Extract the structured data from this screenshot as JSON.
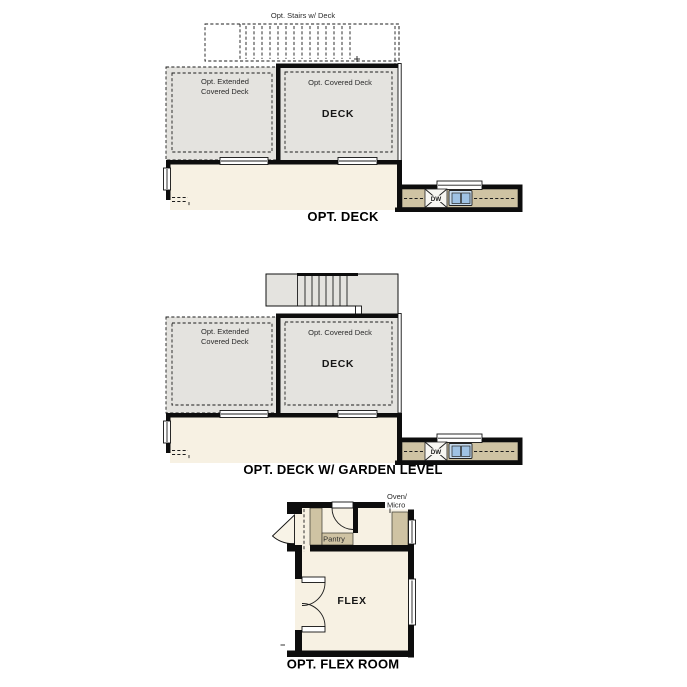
{
  "sheet": {
    "description": "Three optional floor plan diagrams stacked vertically"
  },
  "colors": {
    "deck_fill": "#e4e3df",
    "interior_fill": "#f7f1e3",
    "counter_fill": "#cfc3a3",
    "wall": "#0d0d0d",
    "sink_outer": "#c7dbee",
    "sink_basin": "#9fc2e4",
    "background": "#ffffff"
  },
  "plans": [
    {
      "title": "OPT. DECK",
      "stairs_label": "Opt. Stairs w/ Deck",
      "extended_deck_line1": "Opt. Extended",
      "extended_deck_line2": "Covered Deck",
      "covered_deck_label": "Opt. Covered Deck",
      "deck_label": "DECK",
      "dishwasher_label": "DW"
    },
    {
      "title": "OPT. DECK W/ GARDEN LEVEL",
      "extended_deck_line1": "Opt. Extended",
      "extended_deck_line2": "Covered Deck",
      "covered_deck_label": "Opt. Covered Deck",
      "deck_label": "DECK",
      "dishwasher_label": "DW"
    },
    {
      "title": "OPT. FLEX ROOM",
      "flex_label": "FLEX",
      "pantry_label": "Pantry",
      "oven_line1": "Oven/",
      "oven_line2": "Micro"
    }
  ]
}
